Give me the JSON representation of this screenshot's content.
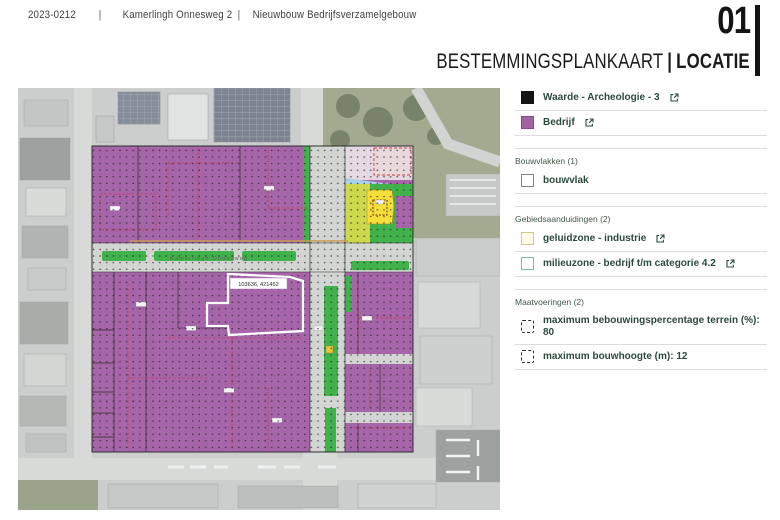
{
  "header": {
    "project_number": "2023-0212",
    "separator": "|",
    "address": "Kamerlingh Onnesweg 2",
    "project_name": "Nieuwbouw Bedrijfsverzamelgebouw"
  },
  "title_block": {
    "page_number": "01",
    "title": "BESTEMMINGSPLANKAART",
    "separator": "|",
    "subtitle": "LOCATIE"
  },
  "map": {
    "street_label": "Kamerlingh Onnesweg",
    "parcel_label": "103636, 421452"
  },
  "legend": {
    "items_top": [
      {
        "label": "Waarde - Archeologie - 3",
        "swatch_fill": "#141414",
        "swatch_border": "#141414",
        "has_link": true
      },
      {
        "label": "Bedrijf",
        "swatch_fill": "#a263a5",
        "swatch_border": "#7c4f82",
        "has_link": true
      }
    ],
    "sections": [
      {
        "header": "Bouwvlakken (1)",
        "items": [
          {
            "label": "bouwvlak",
            "swatch_fill": "#ffffff",
            "swatch_border": "#7d8489",
            "has_link": false
          }
        ]
      },
      {
        "header": "Gebiedsaanduidingen (2)",
        "items": [
          {
            "label": "geluidzone - industrie",
            "swatch_fill": "#fffbe6",
            "swatch_border": "#d5c887",
            "has_link": true
          },
          {
            "label": "milieuzone - bedrijf t/m categorie 4.2",
            "swatch_fill": "#ffffff",
            "swatch_border": "#7fbe92",
            "has_link": true
          }
        ]
      },
      {
        "header": "Maatvoeringen (2)",
        "items": [
          {
            "label": "maximum bebouwingspercentage terrein (%): 80",
            "swatch_fill": "#ffffff",
            "swatch_border": "#2b2b2b",
            "has_link": false
          },
          {
            "label": "maximum bouwhoogte (m): 12",
            "swatch_fill": "#ffffff",
            "swatch_border": "#2b2b2b",
            "has_link": false
          }
        ]
      }
    ]
  },
  "colors": {
    "bedrijf_purple": "#a765a9",
    "green_zone": "#41b14b",
    "yellow_parcel": "#f4df3b",
    "yellow_green_zone": "#ccd94d",
    "light_blue_zone": "#a8d2e6",
    "pink_zone": "#e6d8e2",
    "road_gray": "#d3d5d3",
    "photo_base": "#cbcecc",
    "legend_text": "#2b4a3c",
    "accent_black": "#141414"
  }
}
